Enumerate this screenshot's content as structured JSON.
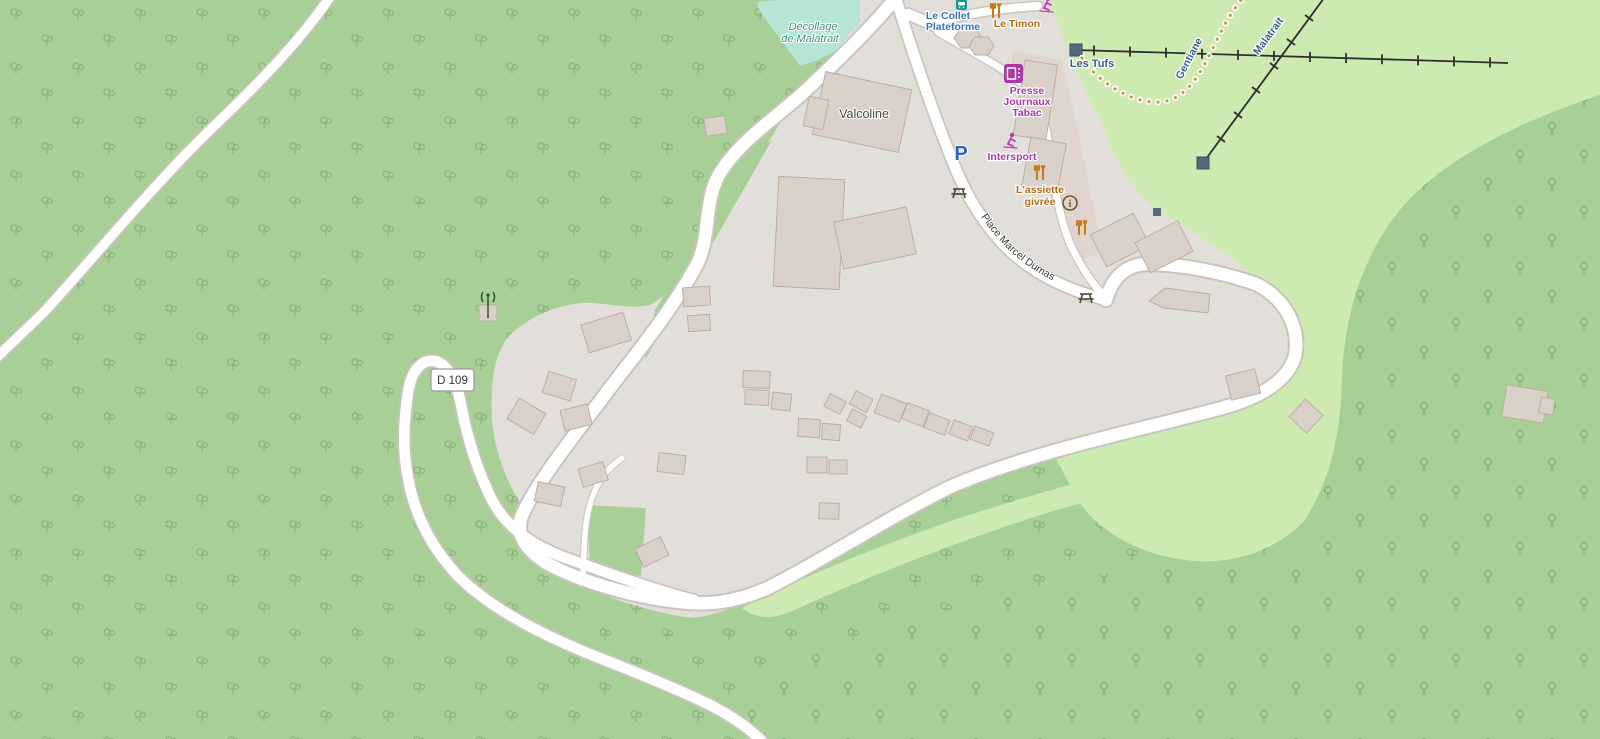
{
  "labels": {
    "bus_stop_line1": "Le Collet",
    "bus_stop_line2": "Plateforme",
    "restaurant_top": "Le Timon",
    "station_right": "Les Tufs",
    "shop_line1": "Presse",
    "shop_line2": "Journaux",
    "shop_line3": "Tabac",
    "sports_shop": "Intersport",
    "restaurant_mid_line1": "L'assiette",
    "restaurant_mid_line2": "givrée",
    "building_complex": "Valcoline",
    "takeoff_line1": "Décollage",
    "takeoff_line2": "de Malatrait",
    "road_ref": "D 109",
    "street_name": "Place Marcel Dumas",
    "lift_name_left": "Gentiane",
    "lift_name_right": "Malatrait",
    "parking": "P",
    "info": "i"
  },
  "colors": {
    "forest": "#a8d096",
    "grass": "#cdebb0",
    "pitch": "#b5e5d4",
    "residential": "#e2dfdb",
    "retail": "#e0d5ce",
    "road_fill": "#ffffff",
    "road_casing": "#c9c4be",
    "building_fill": "#d9d0c9",
    "building_stroke": "#b9ab9c",
    "transit_blue": "#3573b9",
    "restaurant_orange": "#b4690e",
    "shop_purple": "#a939a4",
    "lift_label_blue": "#33618e",
    "pitch_label_teal": "#3f9382",
    "parking_blue": "#2a62c4",
    "path_dot_yellow": "#c49a52"
  }
}
